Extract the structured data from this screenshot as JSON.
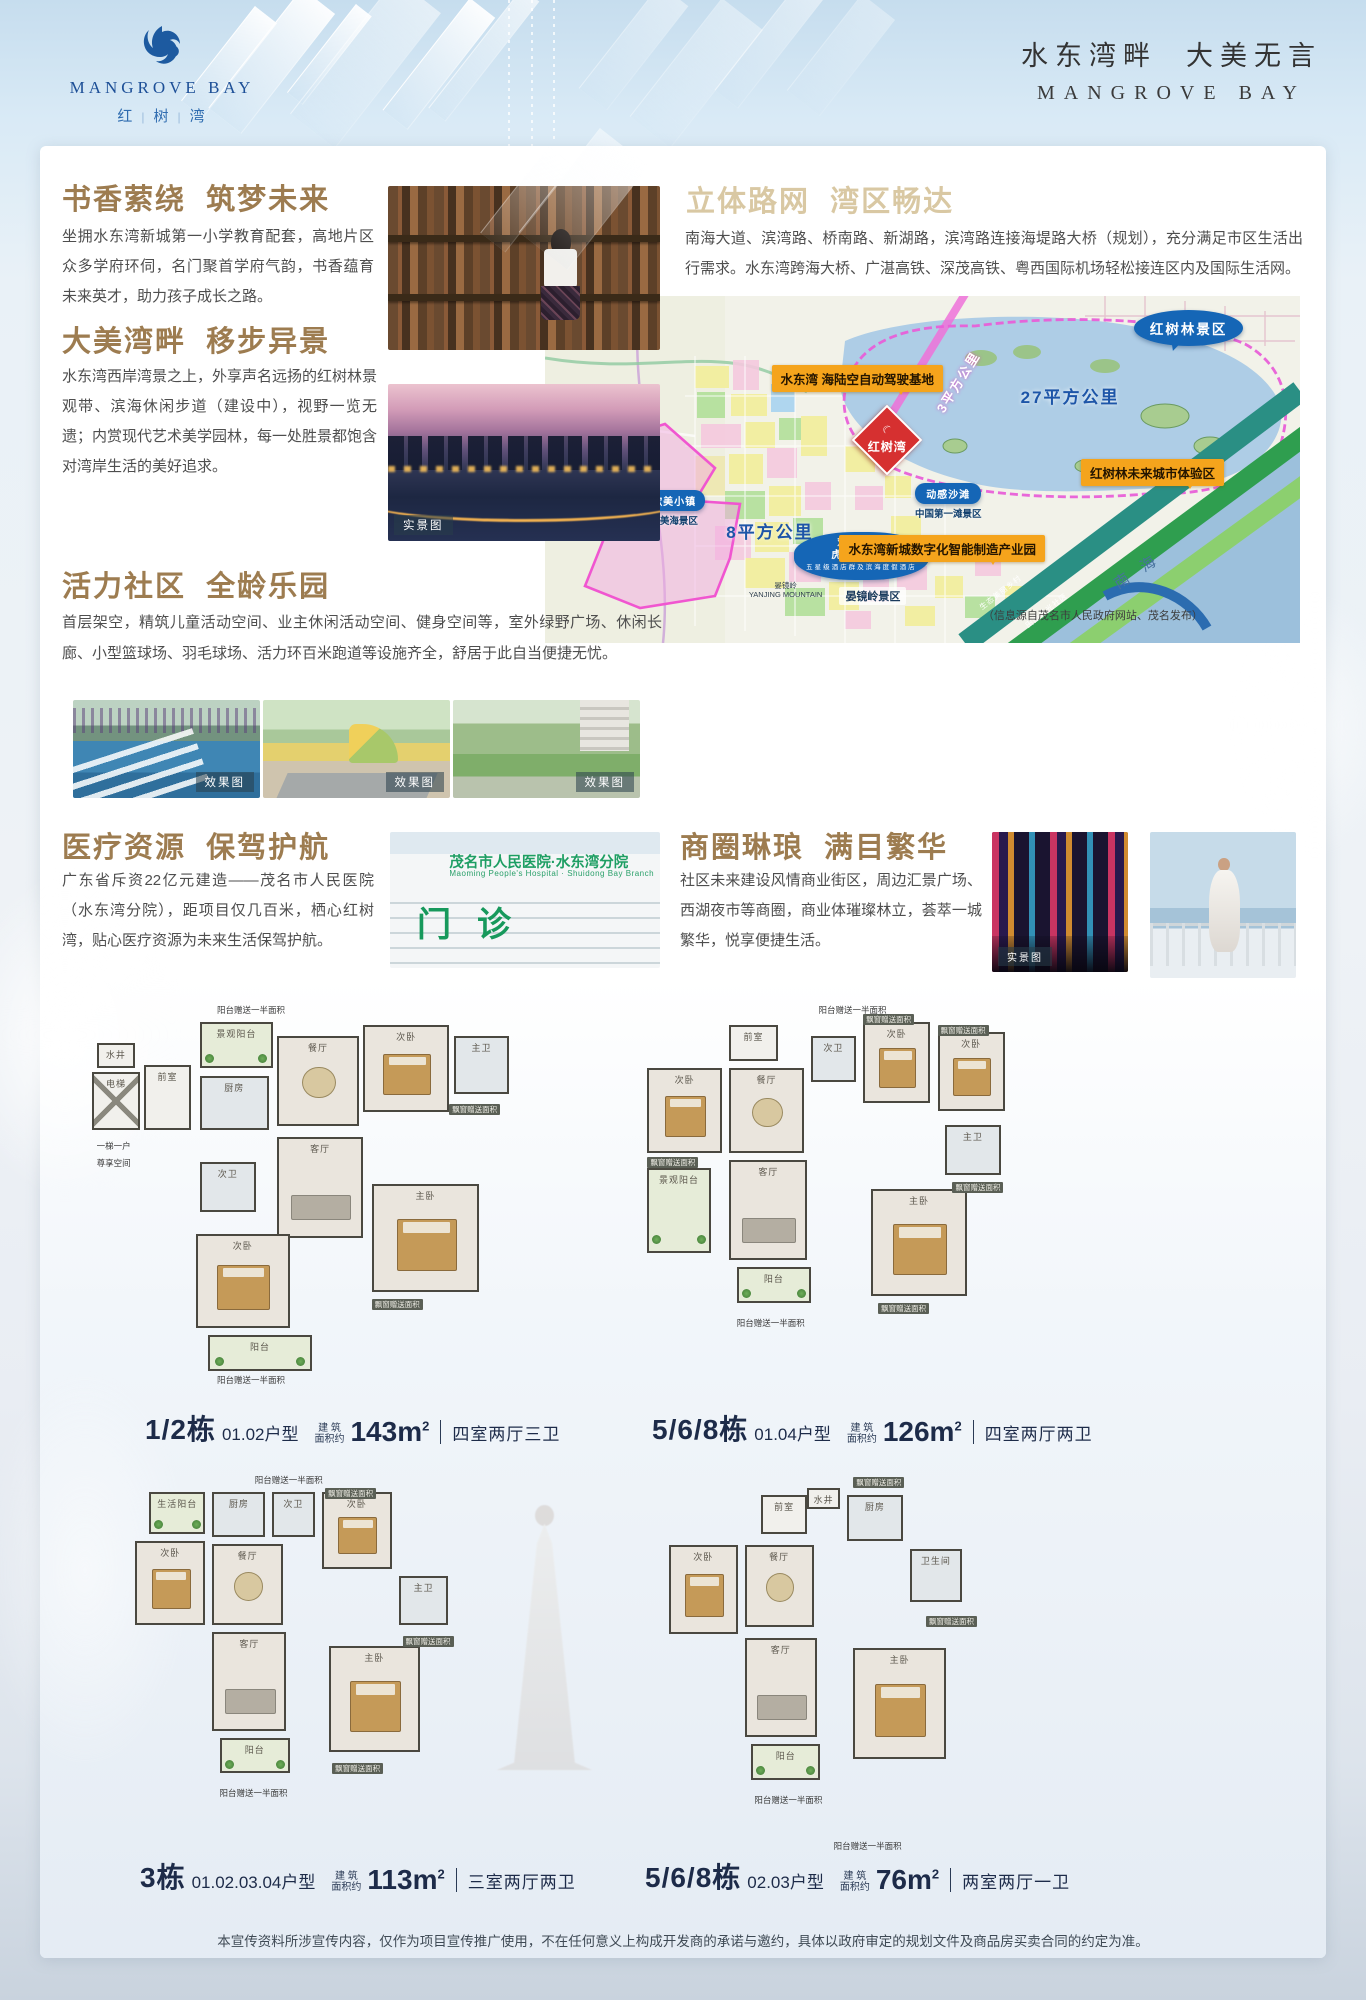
{
  "header": {
    "logo": {
      "icon": "phoenix-bird-icon",
      "brand_en": "MANGROVE BAY",
      "brand_cn_chars": [
        "红",
        "树",
        "湾"
      ]
    },
    "slogan_cn": "水东湾畔  大美无言",
    "slogan_en": "MANGROVE BAY"
  },
  "sections": {
    "education": {
      "title": "书香萦绕  筑梦未来",
      "body": "坐拥水东湾新城第一小学教育配套，高地片区众多学府环伺，名门聚首学府气韵，书香蕴育未来英才，助力孩子成长之路。"
    },
    "bay": {
      "title": "大美湾畔  移步异景",
      "body": "水东湾西岸湾景之上，外享声名远扬的红树林景观带、滨海休闲步道（建设中），视野一览无遗；内赏现代艺术美学园林，每一处胜景都饱含对湾岸生活的美好追求。",
      "photo_tag": "实景图"
    },
    "community": {
      "title": "活力社区  全龄乐园",
      "body": "首层架空，精筑儿童活动空间、业主休闲活动空间、健身空间等，室外绿野广场、休闲长廊、小型篮球场、羽毛球场、活力环百米跑道等设施齐全，舒居于此自当便捷无忧。",
      "photo_tags": [
        "效果图",
        "效果图",
        "效果图"
      ]
    },
    "medical": {
      "title": "医疗资源  保驾护航",
      "body": "广东省斥资22亿元建造——茂名市人民医院（水东湾分院），距项目仅几百米，栖心红树湾，贴心医疗资源为未来生活保驾护航。",
      "photo_sign_line1": "茂名市人民医院·水东湾分院",
      "photo_sign_line2": "Maoming People's Hospital · Shuidong Bay Branch",
      "photo_sign_big": "门诊"
    },
    "roads": {
      "title": "立体路网  湾区畅达",
      "body": "南海大道、滨湾路、桥南路、新湖路，滨湾路连接海堤路大桥（规划），充分满足市区生活出行需求。水东湾跨海大桥、广湛高铁、深茂高铁、粤西国际机场轻松接连区内及国际生活网。"
    },
    "business": {
      "title": "商圈琳琅  满目繁华",
      "body": "社区未来建设风情商业街区，周边汇景广场、西湖夜市等商圈，商业体璀璨林立，荟萃一城繁华，悦享便捷生活。",
      "photo_tag": "实景图"
    }
  },
  "map": {
    "labels": [
      {
        "cls": "orange",
        "t": "水东湾 海陆空自动驾驶基地",
        "x": 30,
        "y": 20
      },
      {
        "cls": "rot3",
        "t": "3平方公里",
        "x": 50,
        "y": 22
      },
      {
        "cls": "blue-big",
        "t": "27平方公里",
        "x": 63,
        "y": 25
      },
      {
        "cls": "bubble",
        "t": "红树林景区",
        "x": 78,
        "y": 4
      },
      {
        "cls": "marker",
        "t": "红树湾",
        "x": 41.5,
        "y": 33
      },
      {
        "cls": "orange",
        "t": "红树林未来城市体验区",
        "x": 71,
        "y": 47
      },
      {
        "cls": "blue-big",
        "t": "8平方公里",
        "x": 24,
        "y": 64
      },
      {
        "cls": "orange",
        "t": "水东湾新城数字化智能制造产业园",
        "x": 39,
        "y": 69
      },
      {
        "cls": "bubble-sm",
        "t": "歌美小镇",
        "sub": "歌美海景区",
        "x": 13,
        "y": 56
      },
      {
        "cls": "bubble-sm",
        "t": "动感沙滩",
        "sub": "中国第一滩景区",
        "x": 49,
        "y": 54
      },
      {
        "cls": "bubble-multi",
        "t": "欢乐海岸\n虎头山景区",
        "sub2": "五星级酒店群及滨海度假酒店",
        "x": 33,
        "y": 68
      },
      {
        "cls": "tiny-dark",
        "t": "晏镜岭\nYANJING MOUNTAIN",
        "x": 27,
        "y": 82
      },
      {
        "cls": "dark-txt",
        "t": "晏镜岭景区",
        "x": 39,
        "y": 84
      },
      {
        "cls": "rot-sea",
        "t": "南 海",
        "x": 75,
        "y": 76
      },
      {
        "cls": "strip-txt",
        "t": "生态美丽乡村",
        "x": 57,
        "y": 84
      },
      {
        "cls": "strip-txt",
        "t": "田园风光社区",
        "x": 63,
        "y": 89
      },
      {
        "cls": "note",
        "t": "（信息源自茂名市人民政府网站、茂名发布）",
        "x": 58,
        "y": 89.5
      }
    ]
  },
  "captions_common": {
    "area_l1": "建 筑",
    "area_l2": "面积约",
    "area_unit": "m",
    "area_sup": "2"
  },
  "floor_plans": [
    {
      "building": "1/2栋",
      "unit": "01.02户型",
      "area_num": "143",
      "layout": "四室两厅三卫",
      "rooms": [
        {
          "t": "水井",
          "x": 2,
          "y": 7,
          "w": 9,
          "h": 7,
          "c": "core"
        },
        {
          "t": "电梯",
          "x": 1,
          "y": 15,
          "w": 11,
          "h": 16,
          "c": "core",
          "el": 1
        },
        {
          "t": "前室",
          "x": 13,
          "y": 13,
          "w": 11,
          "h": 18,
          "c": "core"
        },
        {
          "t": "景观阳台",
          "x": 26,
          "y": 1,
          "w": 17,
          "h": 13,
          "c": "bal"
        },
        {
          "t": "餐厅",
          "x": 44,
          "y": 5,
          "w": 19,
          "h": 25,
          "c": "rm",
          "f": "table"
        },
        {
          "t": "次卧",
          "x": 64,
          "y": 2,
          "w": 20,
          "h": 24,
          "c": "rm",
          "f": "bed"
        },
        {
          "t": "主卫",
          "x": 85,
          "y": 5,
          "w": 13,
          "h": 16,
          "c": "wet"
        },
        {
          "t": "厨房",
          "x": 26,
          "y": 16,
          "w": 16,
          "h": 15,
          "c": "wet"
        },
        {
          "t": "次卫",
          "x": 26,
          "y": 40,
          "w": 13,
          "h": 14,
          "c": "wet"
        },
        {
          "t": "客厅",
          "x": 44,
          "y": 33,
          "w": 20,
          "h": 28,
          "c": "rm",
          "f": "sofa"
        },
        {
          "t": "主卧",
          "x": 66,
          "y": 46,
          "w": 25,
          "h": 30,
          "c": "rm",
          "f": "bed"
        },
        {
          "t": "次卧",
          "x": 25,
          "y": 60,
          "w": 22,
          "h": 26,
          "c": "rm",
          "f": "bed"
        },
        {
          "t": "阳台",
          "x": 28,
          "y": 88,
          "w": 24,
          "h": 10,
          "c": "bal"
        }
      ],
      "notes": [
        {
          "t": "阳台赠送一半面积",
          "x": 30,
          "y": -4
        },
        {
          "t": "一梯一户",
          "x": 2,
          "y": 34
        },
        {
          "t": "尊享空间",
          "x": 2,
          "y": 38.5
        },
        {
          "t": "飘窗赠送面积",
          "x": 84,
          "y": 24,
          "tag": 1
        },
        {
          "t": "飘窗赠送面积",
          "x": 66,
          "y": 78,
          "tag": 1
        },
        {
          "t": "阳台赠送一半面积",
          "x": 30,
          "y": 99
        }
      ]
    },
    {
      "building": "5/6/8栋",
      "unit": "01.04户型",
      "area_num": "126",
      "layout": "四室两厅两卫",
      "rooms": [
        {
          "t": "前室",
          "x": 24,
          "y": 2,
          "w": 13,
          "h": 10,
          "c": "core"
        },
        {
          "t": "次卧",
          "x": 2,
          "y": 14,
          "w": 20,
          "h": 24,
          "c": "rm",
          "f": "bed"
        },
        {
          "t": "餐厅",
          "x": 24,
          "y": 14,
          "w": 20,
          "h": 24,
          "c": "rm",
          "f": "table"
        },
        {
          "t": "次卫",
          "x": 46,
          "y": 5,
          "w": 12,
          "h": 13,
          "c": "wet"
        },
        {
          "t": "次卧",
          "x": 60,
          "y": 1,
          "w": 18,
          "h": 23,
          "c": "rm",
          "f": "bed"
        },
        {
          "t": "次卧",
          "x": 80,
          "y": 4,
          "w": 18,
          "h": 22,
          "c": "rm",
          "f": "bed"
        },
        {
          "t": "主卫",
          "x": 82,
          "y": 30,
          "w": 15,
          "h": 14,
          "c": "wet"
        },
        {
          "t": "客厅",
          "x": 24,
          "y": 40,
          "w": 21,
          "h": 28,
          "c": "rm",
          "f": "sofa"
        },
        {
          "t": "主卧",
          "x": 62,
          "y": 48,
          "w": 26,
          "h": 30,
          "c": "rm",
          "f": "bed"
        },
        {
          "t": "景观阳台",
          "x": 2,
          "y": 42,
          "w": 17,
          "h": 24,
          "c": "bal"
        },
        {
          "t": "阳台",
          "x": 26,
          "y": 70,
          "w": 20,
          "h": 10,
          "c": "bal"
        }
      ],
      "notes": [
        {
          "t": "阳台赠送一半面积",
          "x": 48,
          "y": -4
        },
        {
          "t": "飘窗赠送面积",
          "x": 60,
          "y": -1,
          "tag": 1
        },
        {
          "t": "飘窗赠送面积",
          "x": 80,
          "y": 2,
          "tag": 1
        },
        {
          "t": "飘窗赠送面积",
          "x": 84,
          "y": 46,
          "tag": 1
        },
        {
          "t": "飘窗赠送面积",
          "x": 2,
          "y": 39,
          "tag": 1
        },
        {
          "t": "飘窗赠送面积",
          "x": 64,
          "y": 80,
          "tag": 1
        },
        {
          "t": "阳台赠送一半面积",
          "x": 26,
          "y": 84
        }
      ]
    },
    {
      "building": "3栋",
      "unit": "01.02.03.04户型",
      "area_num": "113",
      "layout": "三室两厅两卫",
      "rooms": [
        {
          "t": "生活阳台",
          "x": 6,
          "y": 1,
          "w": 16,
          "h": 12,
          "c": "bal"
        },
        {
          "t": "厨房",
          "x": 24,
          "y": 1,
          "w": 15,
          "h": 13,
          "c": "wet"
        },
        {
          "t": "次卫",
          "x": 41,
          "y": 1,
          "w": 12,
          "h": 13,
          "c": "wet"
        },
        {
          "t": "次卧",
          "x": 55,
          "y": 1,
          "w": 20,
          "h": 22,
          "c": "rm",
          "f": "bed"
        },
        {
          "t": "次卧",
          "x": 2,
          "y": 15,
          "w": 20,
          "h": 24,
          "c": "rm",
          "f": "bed"
        },
        {
          "t": "餐厅",
          "x": 24,
          "y": 16,
          "w": 20,
          "h": 23,
          "c": "rm",
          "f": "table"
        },
        {
          "t": "主卫",
          "x": 77,
          "y": 25,
          "w": 14,
          "h": 14,
          "c": "wet"
        },
        {
          "t": "客厅",
          "x": 24,
          "y": 41,
          "w": 21,
          "h": 28,
          "c": "rm",
          "f": "sofa"
        },
        {
          "t": "主卧",
          "x": 57,
          "y": 45,
          "w": 26,
          "h": 30,
          "c": "rm",
          "f": "bed"
        },
        {
          "t": "阳台",
          "x": 26,
          "y": 71,
          "w": 20,
          "h": 10,
          "c": "bal"
        }
      ],
      "notes": [
        {
          "t": "阳台赠送一半面积",
          "x": 36,
          "y": -4
        },
        {
          "t": "飘窗赠送面积",
          "x": 56,
          "y": 0,
          "tag": 1
        },
        {
          "t": "飘窗赠送面积",
          "x": 78,
          "y": 42,
          "tag": 1
        },
        {
          "t": "飘窗赠送面积",
          "x": 58,
          "y": 78,
          "tag": 1
        },
        {
          "t": "阳台赠送一半面积",
          "x": 26,
          "y": 85
        }
      ]
    },
    {
      "building": "5/6/8栋",
      "unit": "02.03户型",
      "area_num": "76",
      "layout": "两室两厅一卫",
      "rooms": [
        {
          "t": "水井",
          "x": 44,
          "y": 0,
          "w": 10,
          "h": 6,
          "c": "core"
        },
        {
          "t": "前室",
          "x": 30,
          "y": 2,
          "w": 14,
          "h": 11,
          "c": "core"
        },
        {
          "t": "厨房",
          "x": 56,
          "y": 2,
          "w": 17,
          "h": 13,
          "c": "wet"
        },
        {
          "t": "次卧",
          "x": 2,
          "y": 16,
          "w": 21,
          "h": 25,
          "c": "rm",
          "f": "bed"
        },
        {
          "t": "餐厅",
          "x": 25,
          "y": 16,
          "w": 21,
          "h": 23,
          "c": "rm",
          "f": "table"
        },
        {
          "t": "卫生间",
          "x": 75,
          "y": 17,
          "w": 16,
          "h": 15,
          "c": "wet"
        },
        {
          "t": "客厅",
          "x": 25,
          "y": 42,
          "w": 22,
          "h": 28,
          "c": "rm",
          "f": "sofa"
        },
        {
          "t": "主卧",
          "x": 58,
          "y": 45,
          "w": 28,
          "h": 31,
          "c": "rm",
          "f": "bed"
        },
        {
          "t": "阳台",
          "x": 27,
          "y": 72,
          "w": 21,
          "h": 10,
          "c": "bal"
        }
      ],
      "notes": [
        {
          "t": "飘窗赠送面积",
          "x": 58,
          "y": -3,
          "tag": 1
        },
        {
          "t": "飘窗赠送面积",
          "x": 80,
          "y": 36,
          "tag": 1
        },
        {
          "t": "阳台赠送一半面积",
          "x": 28,
          "y": 86
        },
        {
          "t": "阳台赠送一半面积",
          "x": 52,
          "y": 99
        }
      ]
    }
  ],
  "disclaimer": "本宣传资料所涉宣传内容，仅作为项目宣传推广使用，不在任何意义上构成开发商的承诺与邀约，具体以政府审定的规划文件及商品房买卖合同的约定为准。"
}
